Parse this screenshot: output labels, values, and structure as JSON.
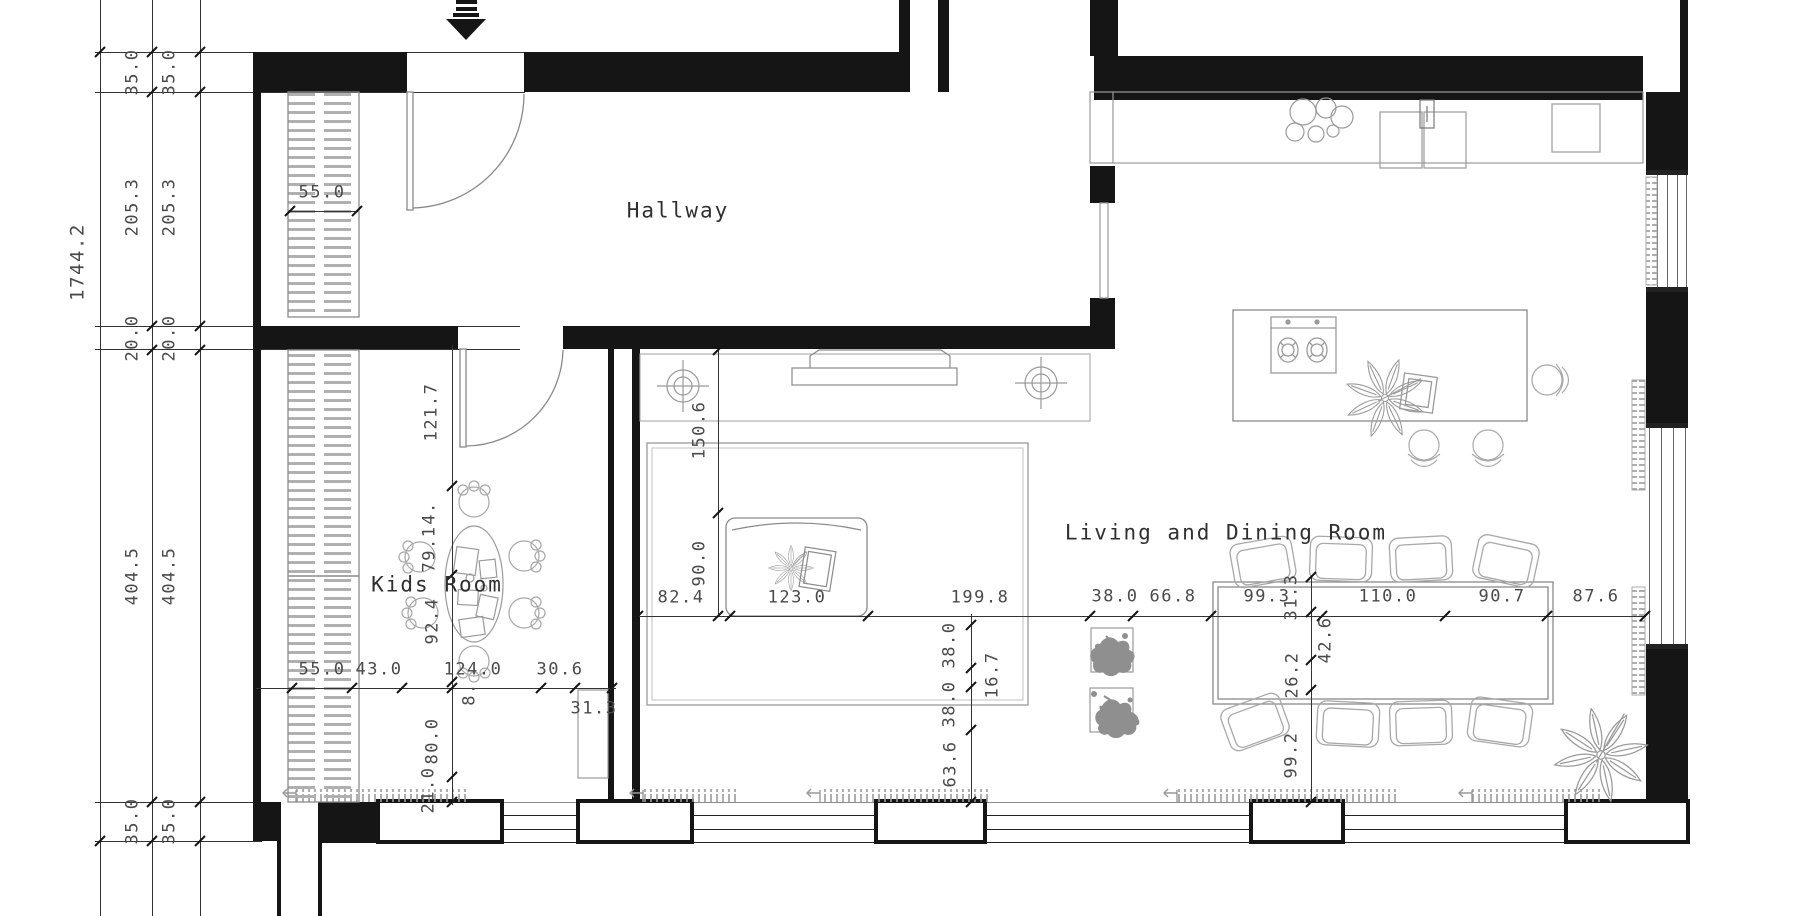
{
  "drawing": {
    "type": "architectural floor plan",
    "units_shown": "centimeters (implied)"
  },
  "colors": {
    "background": "#ffffff",
    "wall": "#151515",
    "dim_line": "#333333",
    "furniture_line": "#9a9a9a",
    "dim_text": "#4a4a4a",
    "room_text": "#2f2f2f"
  },
  "rooms": [
    {
      "name": "Hallway"
    },
    {
      "name": "Kids Room"
    },
    {
      "name": "Living and Dining Room"
    }
  ],
  "icons": [
    {
      "name": "entrance-arrow"
    },
    {
      "name": "door-swing"
    },
    {
      "name": "wardrobe-hatch"
    },
    {
      "name": "ceiling-light"
    },
    {
      "name": "tv"
    },
    {
      "name": "sofa"
    },
    {
      "name": "rug"
    },
    {
      "name": "kitchen-counter"
    },
    {
      "name": "double-sink"
    },
    {
      "name": "faucet"
    },
    {
      "name": "bowl-set"
    },
    {
      "name": "kitchen-island"
    },
    {
      "name": "cooktop"
    },
    {
      "name": "cutting-board"
    },
    {
      "name": "plant"
    },
    {
      "name": "dining-table"
    },
    {
      "name": "dining-chair"
    },
    {
      "name": "island-chair"
    },
    {
      "name": "kids-table"
    },
    {
      "name": "kids-chair"
    },
    {
      "name": "pouf"
    },
    {
      "name": "radiator"
    },
    {
      "name": "window"
    },
    {
      "name": "floor-vent"
    }
  ],
  "dimension_chains": {
    "overall_left_total": "1744.2",
    "left_inner": [
      "35.0",
      "205.3",
      "20.0",
      "404.5",
      "35.0"
    ],
    "left_outer": [
      "35.0",
      "205.3",
      "20.0",
      "404.5",
      "35.0"
    ],
    "hallway_wardrobe_width": "55.0",
    "kids_room_vertical": [
      "121.7",
      "79.1",
      "4.",
      "92.4",
      "8.",
      "80.0",
      "21.0"
    ],
    "kids_room_bottom": [
      "55.0",
      "43.0",
      "124.0",
      "30.6",
      "31.3"
    ],
    "living_width": [
      "82.4",
      "123.0",
      "199.8",
      "38.0",
      "66.8",
      "99.3",
      "110.0",
      "90.7",
      "87.6"
    ],
    "tv_wall_vertical": [
      "150.6",
      "90.0"
    ],
    "rug_vertical": [
      "38.0",
      "16.7",
      "38.0",
      "63.6"
    ],
    "dining_vertical": [
      "31.3",
      "42.6",
      "26.2",
      "99.2"
    ]
  },
  "labels": [
    {
      "t": "1744.2",
      "x": 78,
      "y": 262,
      "r": -90,
      "s": 19
    },
    {
      "t": "35.0",
      "x": 133,
      "y": 72,
      "r": -90
    },
    {
      "t": "35.0",
      "x": 170,
      "y": 72,
      "r": -90
    },
    {
      "t": "205.3",
      "x": 133,
      "y": 207,
      "r": -90
    },
    {
      "t": "205.3",
      "x": 170,
      "y": 207,
      "r": -90
    },
    {
      "t": "20.0",
      "x": 133,
      "y": 338,
      "r": -90
    },
    {
      "t": "20.0",
      "x": 170,
      "y": 338,
      "r": -90
    },
    {
      "t": "404.5",
      "x": 133,
      "y": 576,
      "r": -90
    },
    {
      "t": "404.5",
      "x": 170,
      "y": 576,
      "r": -90
    },
    {
      "t": "35.0",
      "x": 133,
      "y": 821,
      "r": -90
    },
    {
      "t": "35.0",
      "x": 170,
      "y": 821,
      "r": -90
    },
    {
      "t": "55.0",
      "x": 322,
      "y": 193
    },
    {
      "t": "Hallway",
      "x": 678,
      "y": 211,
      "c": "room"
    },
    {
      "t": "Kids Room",
      "x": 437,
      "y": 585,
      "c": "room"
    },
    {
      "t": "Living and Dining Room",
      "x": 1226,
      "y": 533,
      "c": "room"
    },
    {
      "t": "121.7",
      "x": 432,
      "y": 412,
      "r": -90
    },
    {
      "t": "4.",
      "x": 430,
      "y": 513,
      "r": -90
    },
    {
      "t": "79.1",
      "x": 430,
      "y": 549,
      "r": -90
    },
    {
      "t": "92.4",
      "x": 433,
      "y": 621,
      "r": -90
    },
    {
      "t": "8.",
      "x": 470,
      "y": 694,
      "r": -90
    },
    {
      "t": "80.0",
      "x": 433,
      "y": 741,
      "r": -90
    },
    {
      "t": "21.0",
      "x": 429,
      "y": 790,
      "r": -90
    },
    {
      "t": "55.0",
      "x": 322,
      "y": 670
    },
    {
      "t": "43.0",
      "x": 379,
      "y": 670
    },
    {
      "t": "124.0",
      "x": 473,
      "y": 670
    },
    {
      "t": "30.6",
      "x": 560,
      "y": 670
    },
    {
      "t": "31.3",
      "x": 594,
      "y": 709
    },
    {
      "t": "150.6",
      "x": 700,
      "y": 430,
      "r": -90
    },
    {
      "t": "90.0",
      "x": 700,
      "y": 563,
      "r": -90
    },
    {
      "t": "82.4",
      "x": 681,
      "y": 598
    },
    {
      "t": "123.0",
      "x": 797,
      "y": 598
    },
    {
      "t": "199.8",
      "x": 980,
      "y": 598
    },
    {
      "t": "38.0",
      "x": 1115,
      "y": 597
    },
    {
      "t": "66.8",
      "x": 1173,
      "y": 597
    },
    {
      "t": "99.3",
      "x": 1267,
      "y": 597
    },
    {
      "t": "110.0",
      "x": 1388,
      "y": 597
    },
    {
      "t": "90.7",
      "x": 1502,
      "y": 597
    },
    {
      "t": "87.6",
      "x": 1596,
      "y": 597
    },
    {
      "t": "38.0",
      "x": 950,
      "y": 645,
      "r": -90
    },
    {
      "t": "16.7",
      "x": 993,
      "y": 675,
      "r": -90
    },
    {
      "t": "38.0",
      "x": 950,
      "y": 704,
      "r": -90
    },
    {
      "t": "63.6",
      "x": 951,
      "y": 764,
      "r": -90
    },
    {
      "t": "31.3",
      "x": 1292,
      "y": 597,
      "r": -90
    },
    {
      "t": "42.6",
      "x": 1326,
      "y": 640,
      "r": -90
    },
    {
      "t": "26.2",
      "x": 1293,
      "y": 675,
      "r": -90
    },
    {
      "t": "99.2",
      "x": 1292,
      "y": 755,
      "r": -90
    }
  ]
}
